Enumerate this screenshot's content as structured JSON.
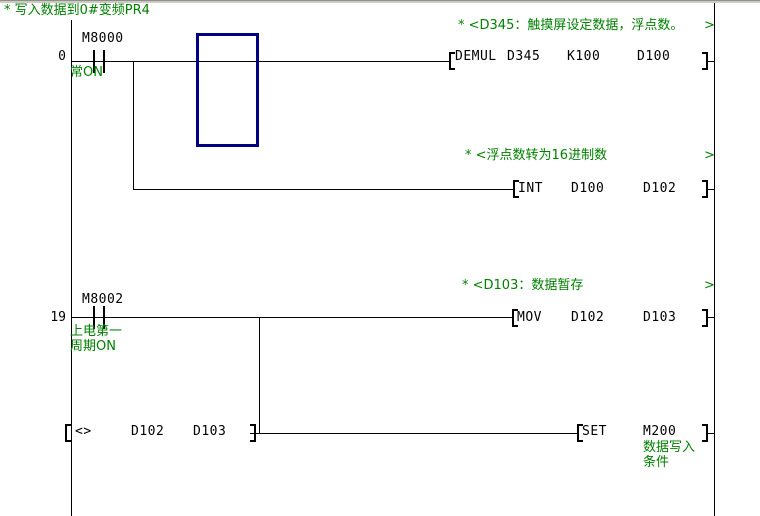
{
  "colors": {
    "comment_green": "#008000",
    "cursor_navy": "#000080",
    "line_black": "#000000",
    "background": "#ffffff"
  },
  "comments": {
    "main": "* 写入数据到0#变频PR4",
    "d345": "* <D345：触摸屏设定数据，浮点数。",
    "d345_end": ">",
    "float16": "* <浮点数转为16进制数",
    "float16_end": ">",
    "d103": "* <D103：数据暂存",
    "d103_end": ">"
  },
  "rung1": {
    "step": "0",
    "contact": "M8000",
    "contact_note": "常ON",
    "op": "DEMUL",
    "operand1": "D345",
    "operand2": "K100",
    "operand3": "D100"
  },
  "rung2": {
    "op": "INT",
    "operand1": "D100",
    "operand2": "D102"
  },
  "rung3": {
    "step": "19",
    "contact": "M8002",
    "contact_note_line1": "上电第一",
    "contact_note_line2": "周期ON",
    "op": "MOV",
    "operand1": "D102",
    "operand2": "D103"
  },
  "rung4": {
    "cmp_op": "<>",
    "cmp_operand1": "D102",
    "cmp_operand2": "D103",
    "op": "SET",
    "operand": "M200",
    "coil_note_line1": "数据写入",
    "coil_note_line2": "条件"
  }
}
